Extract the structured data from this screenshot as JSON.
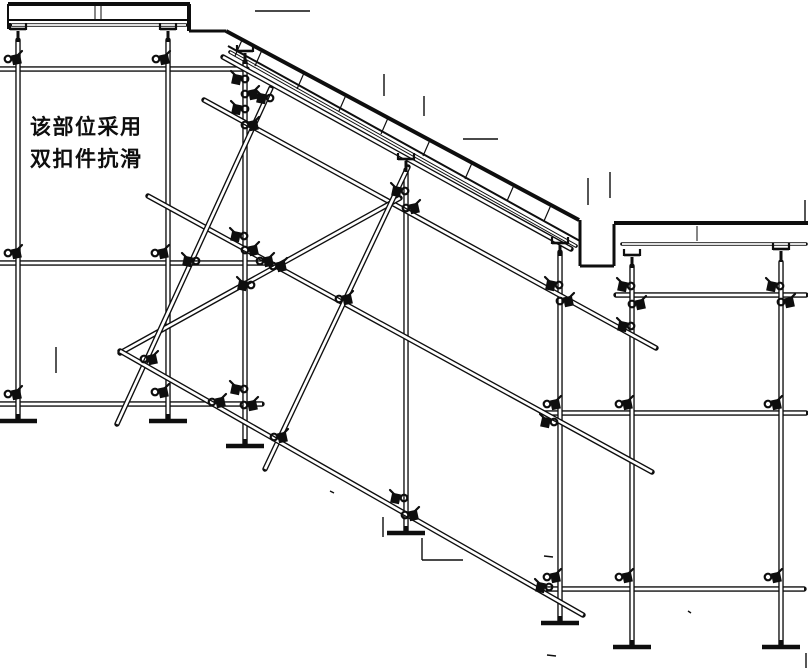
{
  "annotation": {
    "line1": "该部位采用",
    "line2": "双扣件抗滑"
  },
  "colors": {
    "ink": "#0e0e0e",
    "paper": "#ffffff"
  },
  "canvas": {
    "w": 808,
    "h": 668
  },
  "style": {
    "tube_outer": 5.4,
    "tube_inner": 2.7,
    "form_outer": 3.6,
    "form_inner": 1.7
  },
  "diagram": {
    "slab_lines": [
      [
        8,
        4,
        190,
        4,
        4
      ],
      [
        8,
        4,
        8,
        29,
        2
      ],
      [
        8,
        20,
        187,
        20,
        2
      ],
      [
        189,
        4,
        189,
        31,
        4
      ],
      [
        189,
        31,
        226,
        31,
        3
      ],
      [
        95,
        5,
        95,
        19,
        1
      ],
      [
        101,
        5,
        101,
        19,
        1
      ],
      [
        226,
        31,
        579,
        220,
        4
      ],
      [
        228,
        46,
        580,
        241,
        2
      ],
      [
        580,
        220,
        580,
        266,
        3
      ],
      [
        580,
        266,
        614,
        266,
        3
      ],
      [
        614,
        266,
        614,
        224,
        3
      ],
      [
        614,
        223,
        808,
        223,
        4
      ],
      [
        697,
        226,
        697,
        241,
        1
      ]
    ],
    "formwork_tubes": [
      [
        12,
        25,
        186,
        25
      ],
      [
        230,
        52,
        576,
        246
      ],
      [
        622,
        244,
        806,
        244
      ]
    ],
    "ledgers": [
      [
        0,
        69,
        247,
        69
      ],
      [
        0,
        263,
        268,
        263
      ],
      [
        0,
        404,
        262,
        404
      ],
      [
        616,
        295,
        806,
        295
      ],
      [
        545,
        413,
        806,
        413
      ],
      [
        543,
        589,
        804,
        589
      ]
    ],
    "posts": [
      [
        18,
        40,
        18,
        420
      ],
      [
        168,
        40,
        168,
        420
      ],
      [
        245,
        62,
        245,
        445
      ],
      [
        406,
        170,
        406,
        532
      ],
      [
        560,
        252,
        560,
        622
      ],
      [
        632,
        266,
        632,
        646
      ],
      [
        781,
        262,
        781,
        646
      ]
    ],
    "braces": [
      [
        223,
        57,
        571,
        249
      ],
      [
        204,
        100,
        656,
        348
      ],
      [
        148,
        196,
        652,
        472
      ],
      [
        120,
        353,
        400,
        198
      ],
      [
        271,
        88,
        117,
        424
      ],
      [
        408,
        167,
        265,
        469
      ],
      [
        120,
        351,
        583,
        615
      ]
    ],
    "forkheads": [
      [
        18,
        28
      ],
      [
        168,
        28
      ],
      [
        245,
        50
      ],
      [
        406,
        158
      ],
      [
        560,
        242
      ],
      [
        632,
        254
      ],
      [
        781,
        248
      ]
    ],
    "base_plates": [
      [
        18,
        421
      ],
      [
        168,
        421
      ],
      [
        245,
        446
      ],
      [
        406,
        533
      ],
      [
        560,
        623
      ],
      [
        632,
        647
      ],
      [
        781,
        647
      ]
    ],
    "couplers": [
      [
        14,
        60,
        1
      ],
      [
        14,
        254,
        1
      ],
      [
        14,
        395,
        1
      ],
      [
        162,
        60,
        1
      ],
      [
        161,
        254,
        1
      ],
      [
        161,
        393,
        1
      ],
      [
        239,
        80,
        -1
      ],
      [
        251,
        95,
        1
      ],
      [
        239,
        110,
        -1
      ],
      [
        251,
        126,
        1
      ],
      [
        238,
        237,
        -1
      ],
      [
        251,
        251,
        1
      ],
      [
        238,
        390,
        -1
      ],
      [
        250,
        406,
        1
      ],
      [
        399,
        192,
        -1
      ],
      [
        412,
        209,
        1
      ],
      [
        398,
        499,
        -1
      ],
      [
        411,
        516,
        1
      ],
      [
        553,
        286,
        -1
      ],
      [
        566,
        302,
        1
      ],
      [
        553,
        405,
        1
      ],
      [
        553,
        578,
        1
      ],
      [
        625,
        287,
        -1
      ],
      [
        638,
        305,
        1
      ],
      [
        625,
        327,
        -1
      ],
      [
        625,
        405,
        1
      ],
      [
        625,
        578,
        1
      ],
      [
        774,
        287,
        -1
      ],
      [
        787,
        303,
        1
      ],
      [
        774,
        405,
        1
      ],
      [
        774,
        578,
        1
      ],
      [
        280,
        438,
        1
      ],
      [
        150,
        360,
        1
      ],
      [
        345,
        300,
        1
      ],
      [
        218,
        403,
        1
      ],
      [
        266,
        262,
        1
      ],
      [
        190,
        262,
        -1
      ],
      [
        279,
        267,
        1
      ],
      [
        245,
        286,
        -1
      ],
      [
        543,
        588,
        -1
      ],
      [
        548,
        423,
        -1
      ],
      [
        264,
        99,
        -1
      ]
    ],
    "hatch_ticks": [
      [
        242,
        40,
        235,
        56
      ],
      [
        262,
        50,
        255,
        66
      ],
      [
        304,
        73,
        297,
        89
      ],
      [
        346,
        95,
        339,
        111
      ],
      [
        388,
        118,
        381,
        134
      ],
      [
        430,
        140,
        423,
        156
      ],
      [
        472,
        163,
        465,
        179
      ],
      [
        514,
        185,
        507,
        201
      ],
      [
        551,
        205,
        544,
        221
      ]
    ],
    "artifacts": [
      [
        255,
        11,
        310,
        11
      ],
      [
        384,
        74,
        384,
        96
      ],
      [
        424,
        96,
        424,
        116
      ],
      [
        463,
        139,
        498,
        139
      ],
      [
        588,
        178,
        588,
        205
      ],
      [
        610,
        172,
        610,
        198
      ],
      [
        56,
        347,
        56,
        373
      ],
      [
        383,
        517,
        383,
        537
      ],
      [
        422,
        538,
        422,
        560
      ],
      [
        422,
        560,
        463,
        560
      ],
      [
        805,
        200,
        805,
        222
      ],
      [
        806,
        653,
        806,
        668
      ],
      [
        544,
        556,
        553,
        557
      ],
      [
        688,
        611,
        691,
        613
      ],
      [
        547,
        655,
        556,
        656
      ],
      [
        330,
        491,
        334,
        493
      ]
    ]
  }
}
